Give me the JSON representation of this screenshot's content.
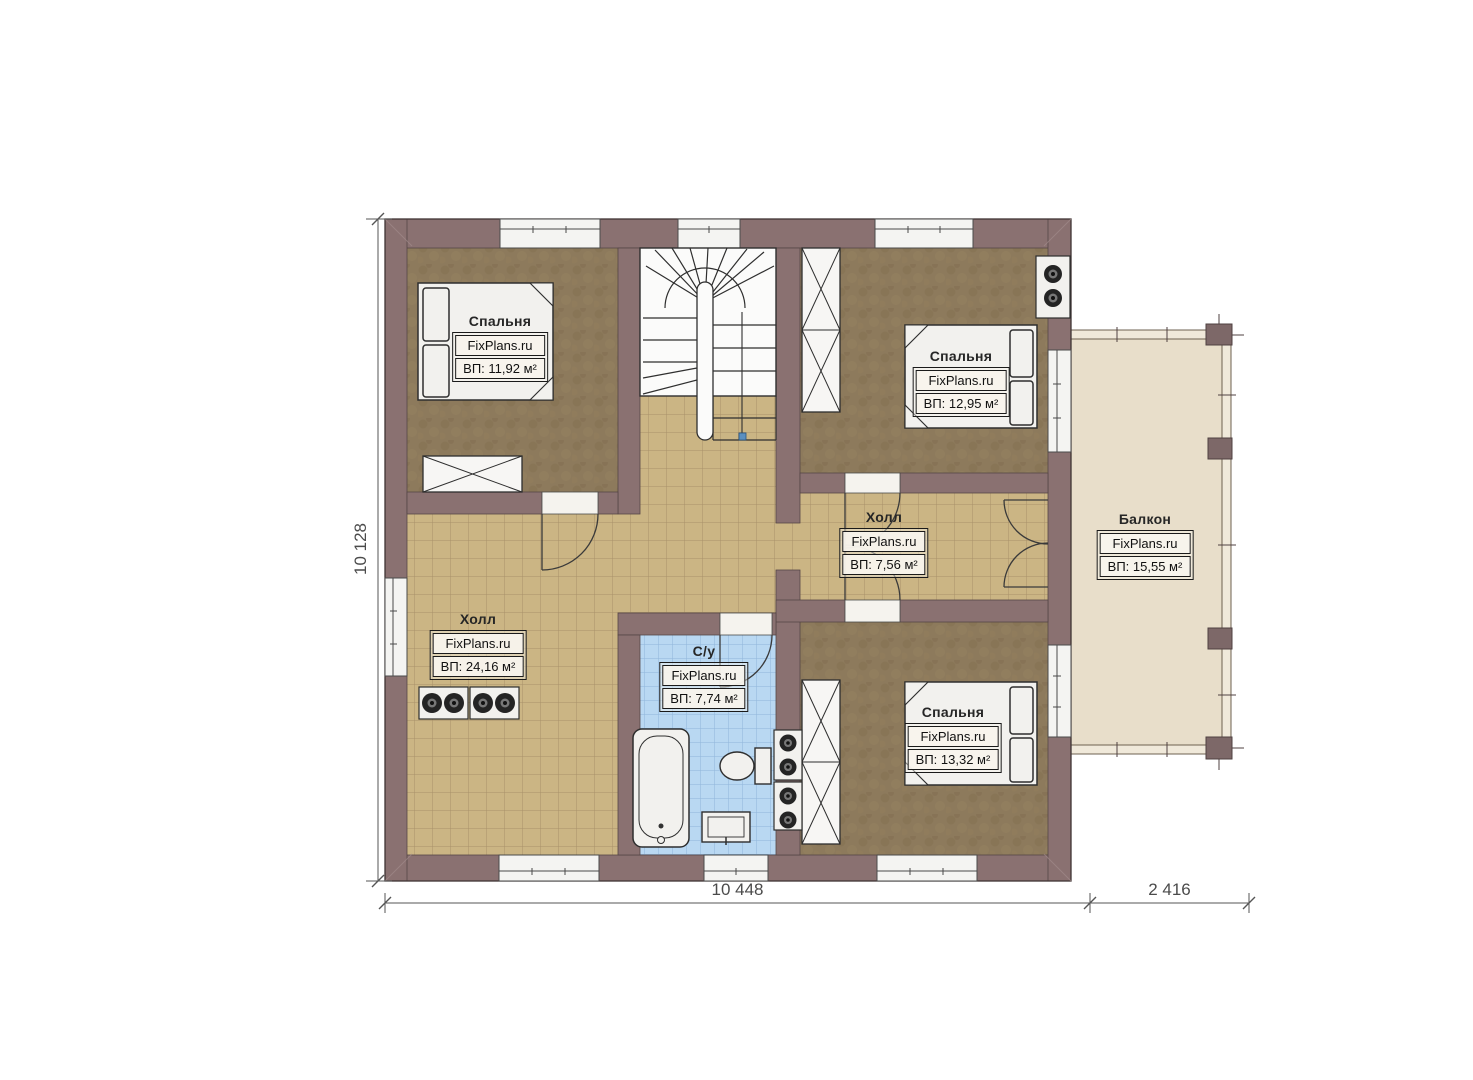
{
  "brand": "FixPlans.ru",
  "rooms": [
    {
      "id": "bedroom-top-left",
      "name": "Спальня",
      "area_label": "ВП: 11,92 м²"
    },
    {
      "id": "bedroom-top-right",
      "name": "Спальня",
      "area_label": "ВП: 12,95 м²"
    },
    {
      "id": "hall-small",
      "name": "Холл",
      "area_label": "ВП: 7,56 м²"
    },
    {
      "id": "balcony",
      "name": "Балкон",
      "area_label": "ВП: 15,55 м²"
    },
    {
      "id": "hall-large",
      "name": "Холл",
      "area_label": "ВП: 24,16 м²"
    },
    {
      "id": "bathroom",
      "name": "С/у",
      "area_label": "ВП: 7,74 м²"
    },
    {
      "id": "bedroom-bottom-right",
      "name": "Спальня",
      "area_label": "ВП: 13,32 м²"
    }
  ],
  "dimensions": {
    "height_total": "10 128",
    "width_main": "10 448",
    "width_balcony": "2 416"
  },
  "colors": {
    "wall": "#8A7171",
    "bedroom_floor": "#8D7A5C",
    "hall_tile": "#CBB584",
    "bath_tile": "#B9D8F2",
    "balcony_floor": "#E8DECA",
    "fixture": "#F2F1EE",
    "dimension_text": "#4B4B4B"
  }
}
